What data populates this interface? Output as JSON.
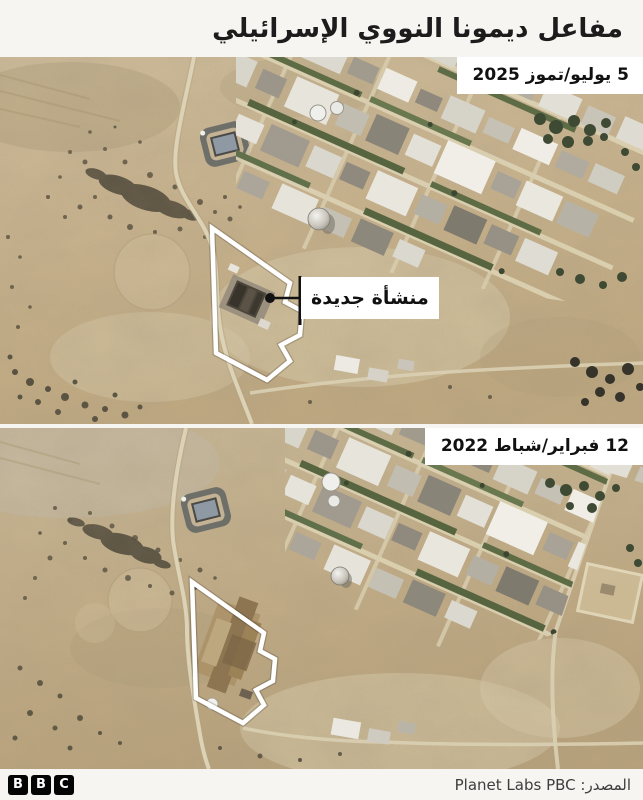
{
  "header": {
    "title": "مفاعل ديمونا النووي الإسرائيلي"
  },
  "panels": {
    "after": {
      "date_label": "5 يوليو/تموز 2025",
      "annotation_label": "منشأة جديدة"
    },
    "before": {
      "date_label": "12 فبراير/شباط 2022"
    }
  },
  "footer": {
    "logo_letters": [
      "B",
      "B",
      "C"
    ],
    "source": "المصدر: Planet Labs PBC"
  },
  "colors": {
    "site_outline": "#ffffff",
    "label_bg": "#ffffff",
    "label_text": "#111111",
    "annotation_line": "#121212"
  }
}
